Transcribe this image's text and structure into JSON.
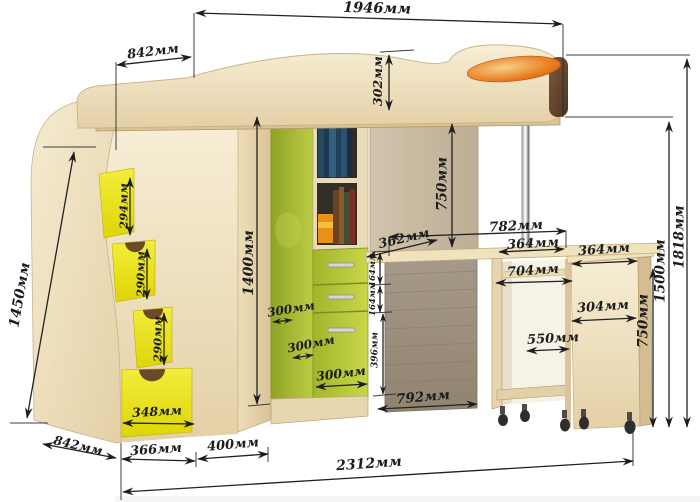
{
  "meta": {
    "unit": "мм",
    "description": "Схема размеров кровати-чердака со ступенями, шкафом и выкатным столом"
  },
  "colors": {
    "wood_light": "#eadbb6",
    "wood_mid": "#dcc69c",
    "panel_dark": "#9e9183",
    "panel_taupe": "#c6b79e",
    "accent_green": "#a9bc33",
    "accent_yellow": "#e9e214",
    "accent_orange": "#e06818",
    "cap_brown": "#5e4229",
    "dim_line": "#222222"
  },
  "dims": {
    "total_top_width": "1946мм",
    "stairs_top_depth": "842мм",
    "rail_height": "302мм",
    "left_side_height": "1450мм",
    "step_1_height": "294мм",
    "step_2_height": "290мм",
    "step_3_height": "290мм",
    "step_drawer_width": "348мм",
    "wardrobe_height": "1400мм",
    "under_bed_clearance": "750мм",
    "desk_surface_depth": "362мм",
    "under_bed_width": "782мм",
    "desk_half_width": "364мм",
    "drawer_1_height": "164мм",
    "drawer_2_height": "164мм",
    "lower_front_height": "396мм",
    "drawer_depth_1": "300мм",
    "drawer_depth_2": "300мм",
    "drawer_front_width": "300мм",
    "corner_panel_width": "792мм",
    "roll_cabinet_top_width": "364мм",
    "roll_desk_inner_width": "704мм",
    "cabinet_front_width": "304мм",
    "roll_desk_clearance": "550мм",
    "cabinet_height": "750мм",
    "desk_level_height": "1500мм",
    "right_total_height": "1818мм",
    "base_side_depth": "842мм",
    "base_stairs_width": "366мм",
    "base_wardrobe_width": "400мм",
    "total_base_width": "2312мм"
  }
}
